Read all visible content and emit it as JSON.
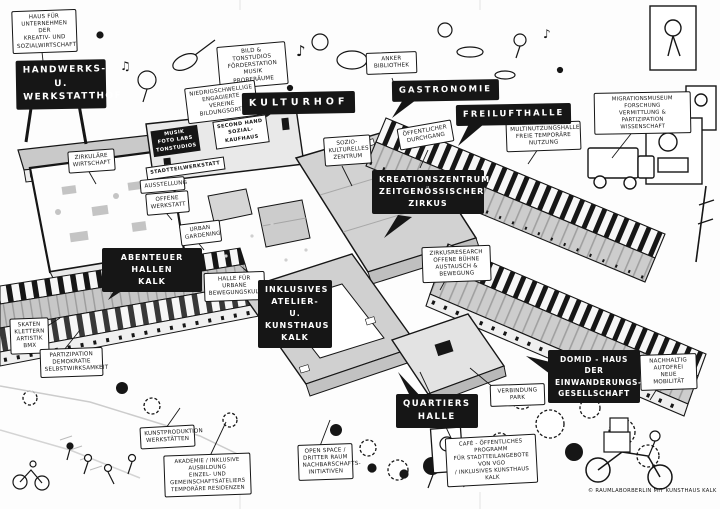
{
  "plates": {
    "handwerkshof": "HANDWERKS- U.\nWERKSTATTHOF",
    "kulturhof": "KULTURHOF",
    "gastronomie": "GASTRONOMIE",
    "freilufthalle": "FREILUFTHALLE",
    "kreationszentrum": "KREATIONSZENTRUM\nZEITGENÖSSISCHER\nZIRKUS",
    "abenteuer_hallen": "ABENTEUER HALLEN\nKALK",
    "inklusives_atelier": "INKLUSIVES\nATELIER- U.\nKUNSTHAUS\nKALK",
    "quartiershalle": "QUARTIERS\nHALLE",
    "domid": "DOMID - HAUS DER\nEINWANDERUNGS-\nGESELLSCHAFT"
  },
  "notes": {
    "haus_unternehmen": "HAUS FÜR\nUNTERNEHMEN DER\nKREATIV- UND\nSOZIALWIRTSCHAFT",
    "bild_tonstudios": "BILD & TONSTUDIOS\nFÖRDERSTATION MUSIK\nPROBERÄUME",
    "niedrigschwellige": "NIEDRIGSCHWELLIGE\nENGAGIERTE VEREINE\nBILDUNGSORTE",
    "anker_bibliothek": "ANKER\nBIBLIOTHEK",
    "multinutzungshalle": "MULTINUTZUNGSHALLE\nFREIE TEMPORÄRE\nNUTZUNG",
    "migrationsmuseum": "MIGRATIONSMUSEUM\nFORSCHUNG\nVERMITTLUNG & PARTIZIPATION\nWISSENSCHAFT",
    "oeffentlicher_durchgang": "ÖFFENTLICHER\nDURCHGANG",
    "sozio_kulturelles": "SOZIO-\nKULTURELLES\nZENTRUM",
    "zirkulaere_wirtschaft": "ZIRKULÄRE\nWIRTSCHAFT",
    "ausstellung": "AUSSTELLUNG",
    "offene_werkstatt": "OFFENE\nWERKSTATT",
    "urban_gardening": "URBAN\nGARDENING",
    "halle_bewegungskultur": "HALLE FÜR URBANE\nBEWEGUNGSKULTUR",
    "zirkusresearch": "ZIRKUSRESEARCH\nOFFENE BÜHNE\nAUSTAUSCH & BEWEGUNG",
    "skaten": "SKATEN\nKLETTERN\nARTISTIK\nBMX",
    "partizipation": "PARTIZIPATION\nDEMOKRATIE\nSELBSTWIRKSAMKEIT",
    "kunstproduktion": "KUNSTPRODUKTION\nWERKSTÄTTEN",
    "akademie": "AKADEMIE / INKLUSIVE AUSBILDUNG\nEINZEL- UND\nGEMEINSCHAFTSATELIERS\nTEMPORÄRE RESIDENZEN",
    "open_space": "OPEN SPACE /\nDRITTER RAUM\nNACHBARSCHAFTS-\nINITIATIVEN",
    "verbindung_park": "VERBINDUNG PARK",
    "cafe": "CAFÉ - ÖFFENTLICHES PROGRAMM\nFÜR STADTTEILANGEBOTE VON VGO\n/ INKLUSIVES KUNSTHAUS KALK",
    "nachhaltig": "NACHHALTIG\nAUTOFREI\nNEUE MOBILITÄT"
  },
  "facade": {
    "studios": "MUSIK\nFOTO LABS\nTONSTUDIOS",
    "kaufhaus": "SECOND HAND\nSOZIAL-\nKAUFHAUS",
    "werkstatt": "STADTTEILWERKSTATT"
  },
  "credit": "© RAUMLABORBERLIN MIT KUNSTHAUS KALK",
  "colors": {
    "ink": "#161616",
    "roof_gray": "#cfcfcf",
    "paper": "#fdfdfd"
  }
}
